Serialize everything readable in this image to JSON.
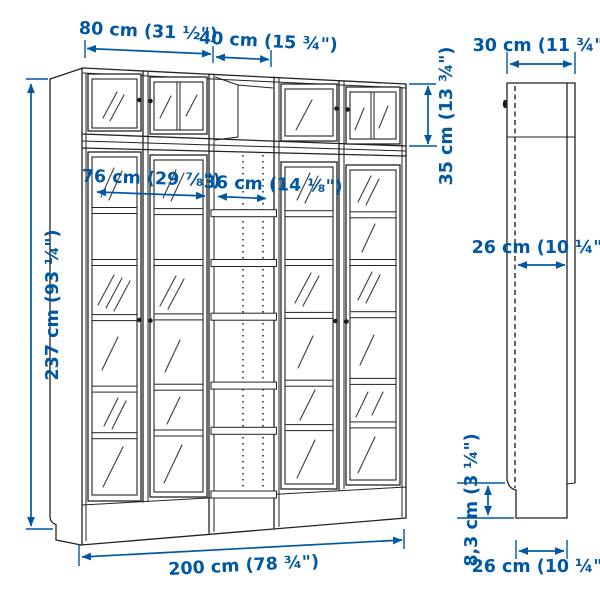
{
  "colors": {
    "dimension_blue": "#0058A3",
    "line_dark": "#222222",
    "background": "#ffffff"
  },
  "diagram": {
    "subject": "bookcase-combination-with-glass-doors",
    "views": [
      "front",
      "side"
    ]
  },
  "dimensions": {
    "left_unit_width": "80 cm (31 ½\")",
    "middle_unit_width": "40 cm (15 ¾\")",
    "left_unit_inner_width": "76 cm (29 ⅞\")",
    "middle_unit_inner_width": "36 cm (14 ⅛\")",
    "total_height": "237 cm (93 ¼\")",
    "extension_height": "35 cm (13 ¾\")",
    "total_width": "200 cm (78 ¾\")",
    "depth_top": "30 cm (11 ¾\")",
    "depth_inner": "26 cm (10 ¼\")",
    "plinth_height": "8,3 cm (3 ¼\")",
    "depth_bottom": "26 cm (10 ¼\")"
  }
}
